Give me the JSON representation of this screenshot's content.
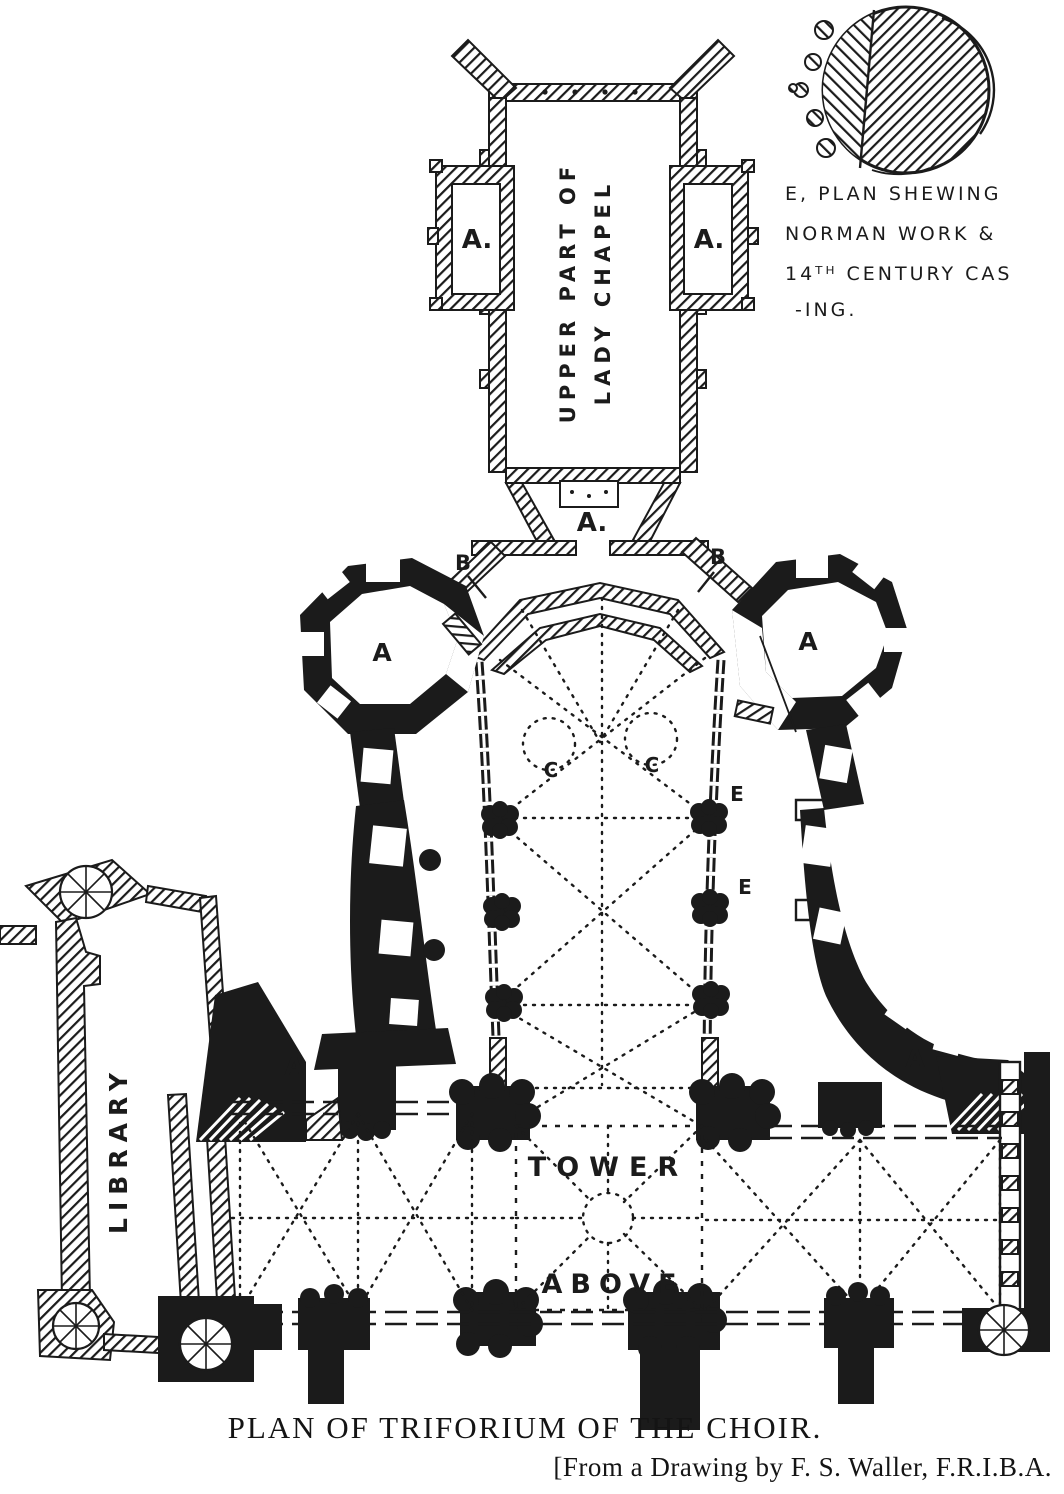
{
  "figure": {
    "caption": "PLAN OF TRIFORIUM OF THE CHOIR.",
    "credit": "[From a Drawing by F. S. Waller, F.R.I.B.A.",
    "ink_color": "#1b1b1b",
    "paper_color": "#ffffff"
  },
  "inset": {
    "line1": "E, PLAN SHEWING",
    "line2": "NORMAN WORK &",
    "line3": "14ᵀᴴ CENTURY CAS",
    "line4": "-ING."
  },
  "plan": {
    "lady_chapel": {
      "label_line1": "UPPER PART OF",
      "label_line2": "LADY CHAPEL"
    },
    "library": {
      "label": "LIBRARY"
    },
    "crossing": {
      "label_line1": "TOWER",
      "label_line2": "ABOVE"
    },
    "markers": {
      "chapel_left": "A.",
      "chapel_right": "A.",
      "gallery_south": "A.",
      "b_left": "B",
      "b_right": "B",
      "octagon_left": "A",
      "octagon_right": "A",
      "c_left": "C",
      "c_right": "C",
      "e_upper": "E",
      "e_lower": "E",
      "transept_left": "A",
      "transept_right": "A"
    }
  }
}
